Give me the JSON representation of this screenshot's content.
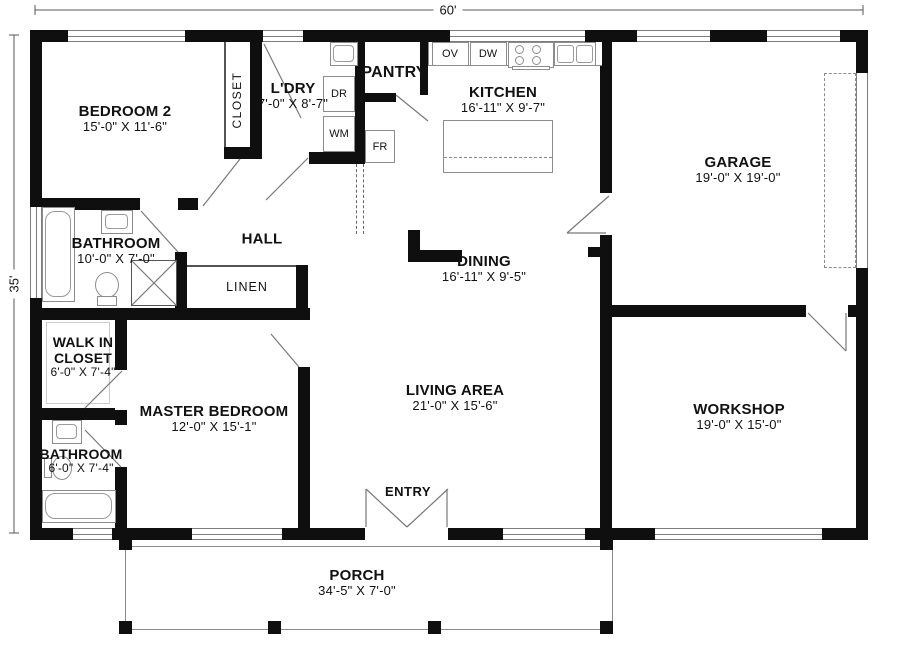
{
  "dimensions": {
    "width_label": "60'",
    "height_label": "35'"
  },
  "rooms": {
    "bedroom2": {
      "name": "BEDROOM 2",
      "dims": "15'-0\" X 11'-6\""
    },
    "closet": {
      "name": "CLOSET"
    },
    "laundry": {
      "name": "L'DRY",
      "dims": "7'-0\" X 8'-7\""
    },
    "pantry": {
      "name": "PANTRY"
    },
    "kitchen": {
      "name": "KITCHEN",
      "dims": "16'-11\" X 9'-7\""
    },
    "garage": {
      "name": "GARAGE",
      "dims": "19'-0\" X 19'-0\""
    },
    "bathroom1": {
      "name": "BATHROOM",
      "dims": "10'-0\" X 7'-0\""
    },
    "hall": {
      "name": "HALL"
    },
    "linen": {
      "name": "LINEN"
    },
    "dining": {
      "name": "DINING",
      "dims": "16'-11\" X 9'-5\""
    },
    "walkin": {
      "name": "WALK IN CLOSET",
      "dims": "6'-0\" X 7'-4\""
    },
    "master": {
      "name": "MASTER BEDROOM",
      "dims": "12'-0\" X 15'-1\""
    },
    "living": {
      "name": "LIVING AREA",
      "dims": "21'-0\" X 15'-6\""
    },
    "workshop": {
      "name": "WORKSHOP",
      "dims": "19'-0\" X 15'-0\""
    },
    "bathroom2": {
      "name": "BATHROOM",
      "dims": "6'-0\" X 7'-4\""
    },
    "entry": {
      "name": "ENTRY"
    },
    "porch": {
      "name": "PORCH",
      "dims": "34'-5\" X 7'-0\""
    }
  },
  "appliances": {
    "oven": "OV",
    "dishwasher": "DW",
    "dryer": "DR",
    "washer": "WM",
    "fridge": "FR"
  },
  "colors": {
    "wall": "#0f0f0f",
    "line": "#8c8c8c",
    "text": "#111111",
    "background": "#ffffff"
  }
}
